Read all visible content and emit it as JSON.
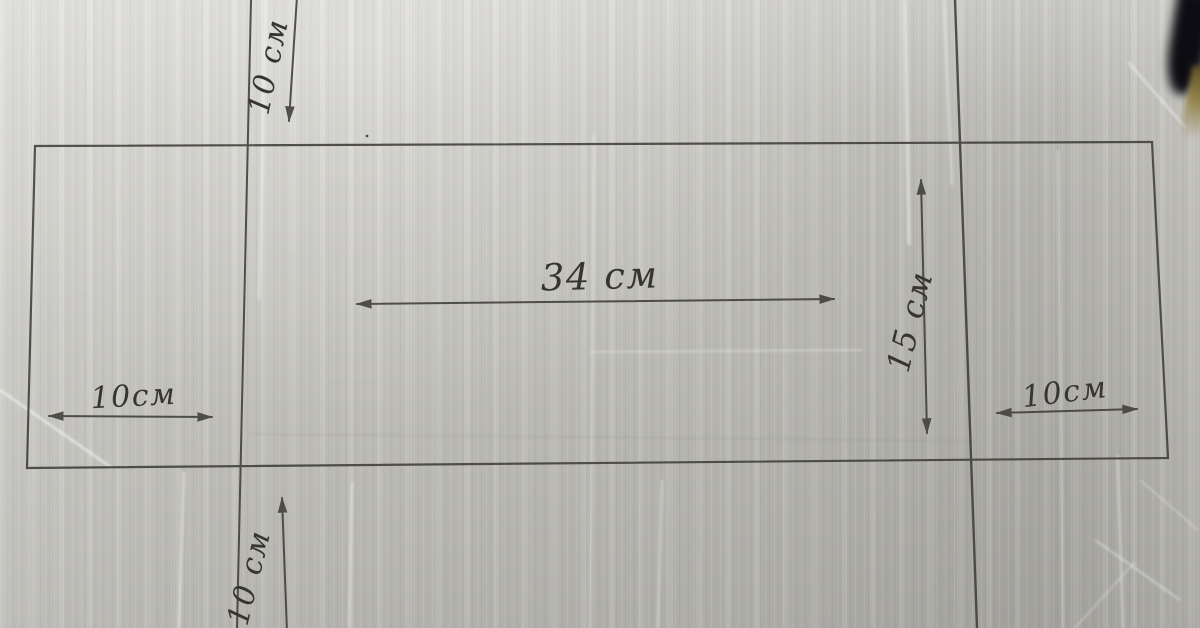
{
  "scene": {
    "kind": "hand-drawn cutting pattern on cardboard",
    "unit": "см"
  },
  "labels": {
    "top_fold": "10 см",
    "bottom_fold": "10 см",
    "width_center": "34 см",
    "height_right": "15 см",
    "left_flap": "10см",
    "right_flap": "10см"
  },
  "values_cm": {
    "top_fold": 10,
    "bottom_fold": 10,
    "width_center": 34,
    "height_right": 15,
    "left_flap": 10,
    "right_flap": 10
  },
  "colors": {
    "cardboard": "#c9c8c2",
    "ink": "#3f3d38",
    "corner_object_dark": "#0c0c12",
    "corner_object_gold": "#94824a"
  }
}
